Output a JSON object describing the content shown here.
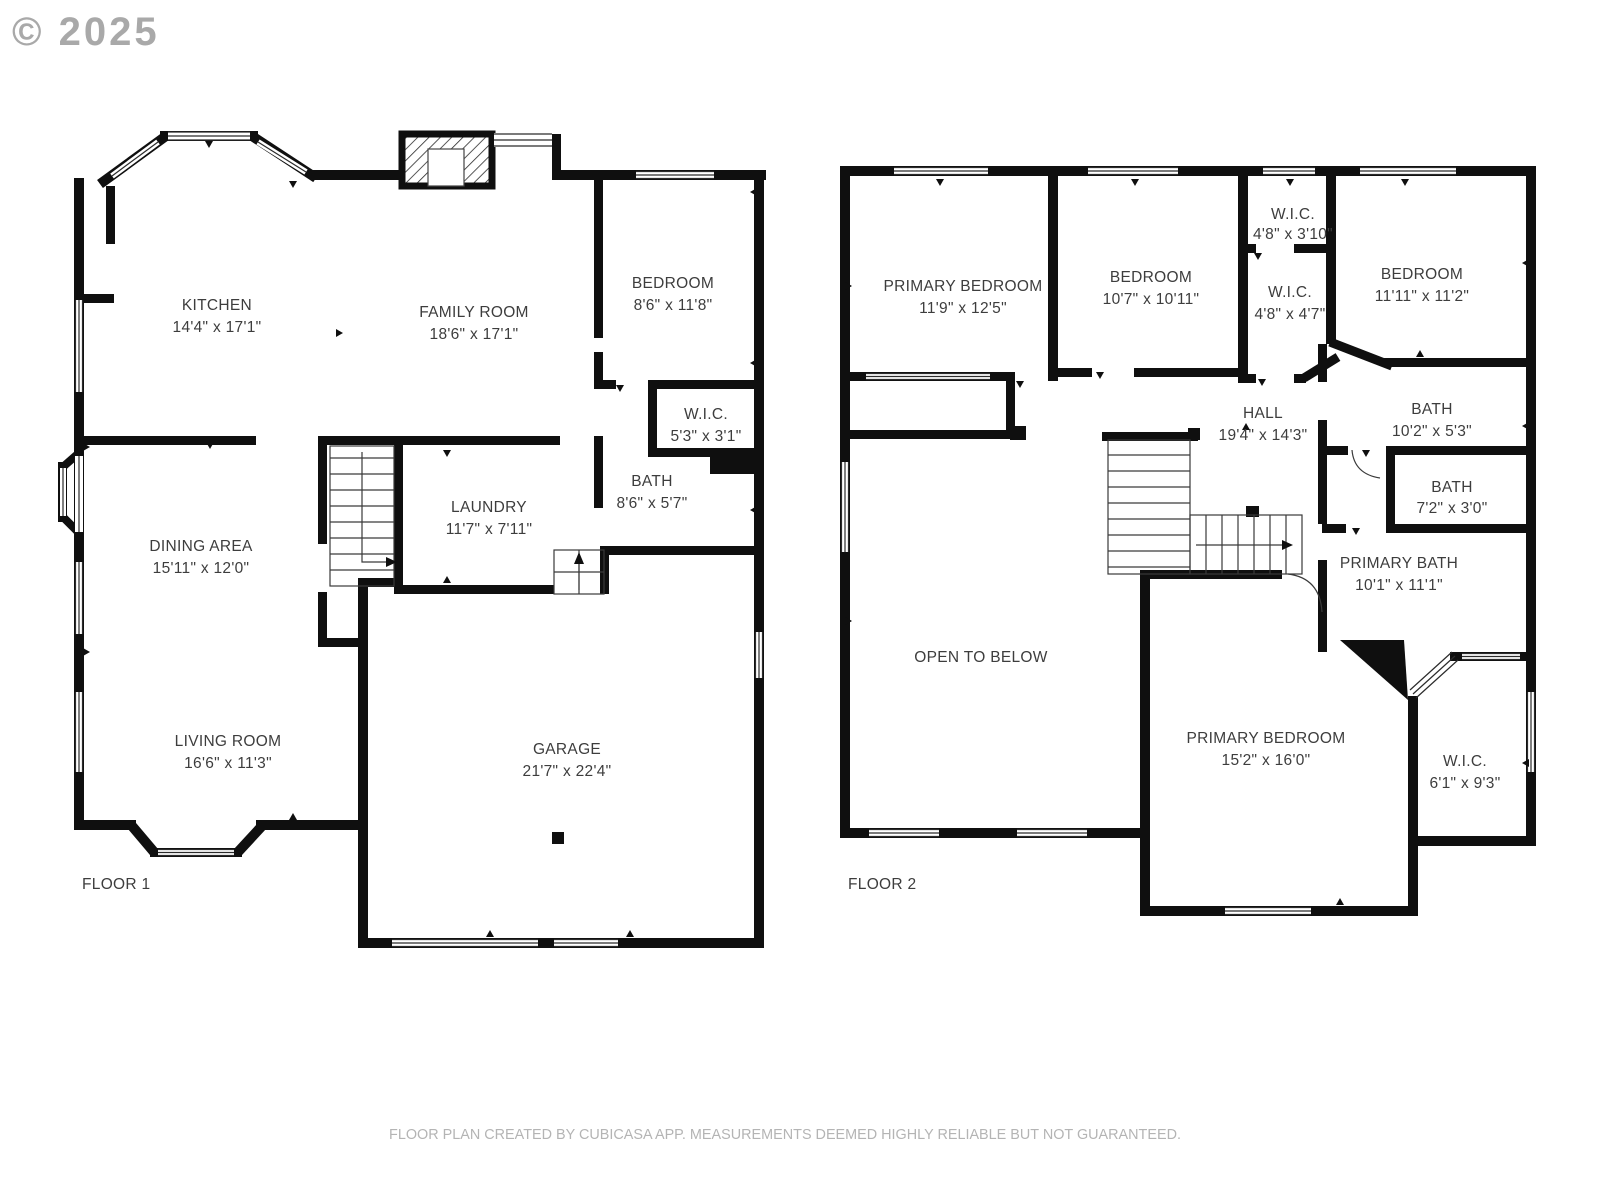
{
  "copyright": "© 2025",
  "footer": "FLOOR PLAN CREATED BY CUBICASA APP. MEASUREMENTS DEEMED HIGHLY RELIABLE BUT NOT GUARANTEED.",
  "floor1": {
    "label": "FLOOR 1",
    "kitchen": {
      "name": "KITCHEN",
      "dims": "14'4\" x 17'1\""
    },
    "family_room": {
      "name": "FAMILY ROOM",
      "dims": "18'6\" x 17'1\""
    },
    "bedroom": {
      "name": "BEDROOM",
      "dims": "8'6\" x 11'8\""
    },
    "wic": {
      "name": "W.I.C.",
      "dims": "5'3\" x 3'1\""
    },
    "bath": {
      "name": "BATH",
      "dims": "8'6\" x 5'7\""
    },
    "laundry": {
      "name": "LAUNDRY",
      "dims": "11'7\" x 7'11\""
    },
    "dining_area": {
      "name": "DINING AREA",
      "dims": "15'11\" x 12'0\""
    },
    "living_room": {
      "name": "LIVING ROOM",
      "dims": "16'6\" x 11'3\""
    },
    "garage": {
      "name": "GARAGE",
      "dims": "21'7\" x 22'4\""
    }
  },
  "floor2": {
    "label": "FLOOR 2",
    "primary_bedroom_1": {
      "name": "PRIMARY BEDROOM",
      "dims": "11'9\" x 12'5\""
    },
    "bedroom_2": {
      "name": "BEDROOM",
      "dims": "10'7\" x 10'11\""
    },
    "wic_1": {
      "name": "W.I.C.",
      "dims": "4'8\" x 3'10\""
    },
    "wic_2": {
      "name": "W.I.C.",
      "dims": "4'8\" x 4'7\""
    },
    "bedroom_3": {
      "name": "BEDROOM",
      "dims": "11'11\" x 11'2\""
    },
    "hall": {
      "name": "HALL",
      "dims": "19'4\" x 14'3\""
    },
    "bath_1": {
      "name": "BATH",
      "dims": "10'2\" x 5'3\""
    },
    "bath_2": {
      "name": "BATH",
      "dims": "7'2\" x 3'0\""
    },
    "primary_bath": {
      "name": "PRIMARY BATH",
      "dims": "10'1\" x 11'1\""
    },
    "open_to_below": {
      "name": "OPEN TO BELOW"
    },
    "primary_bedroom_2": {
      "name": "PRIMARY BEDROOM",
      "dims": "15'2\" x 16'0\""
    },
    "wic_3": {
      "name": "W.I.C.",
      "dims": "6'1\" x 9'3\""
    }
  }
}
